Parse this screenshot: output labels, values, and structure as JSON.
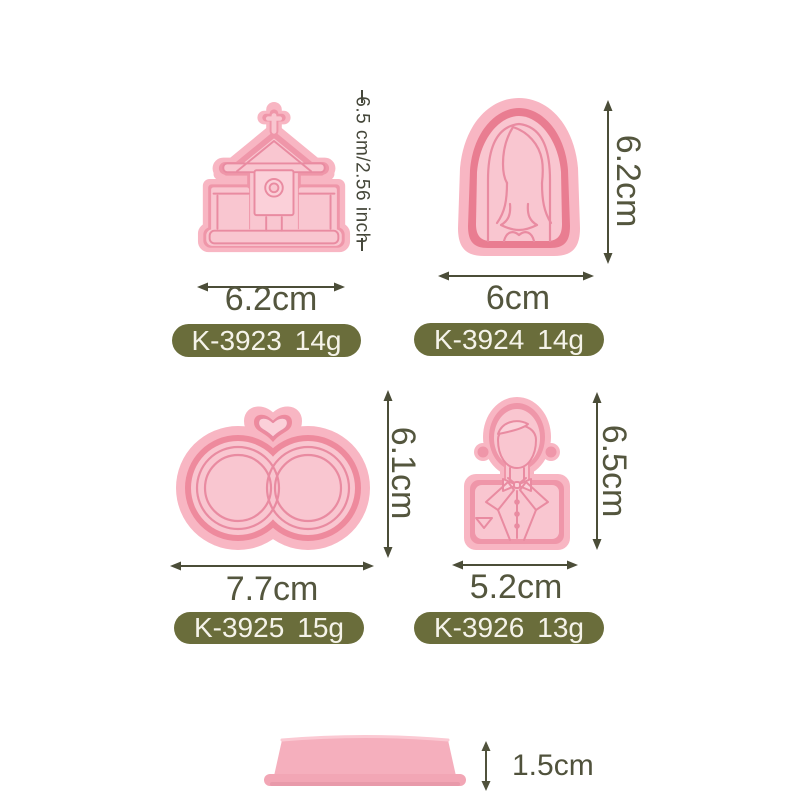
{
  "colors": {
    "cutter_pink": "#f8b6c3",
    "cutter_pink_dark": "#ef96a9",
    "cutter_plate": "#f9c6d0",
    "cutter_line": "#e98ba1",
    "badge_background": "#6a6d3b",
    "badge_text": "#f5f3e9",
    "dimension_text": "#54563e"
  },
  "products": [
    {
      "name": "church cookie cutter",
      "icon": "church-cutter-icon",
      "width": "6.2cm",
      "height": "6.5 cm/2.56 inch",
      "code": "K-3923",
      "weight": "14g"
    },
    {
      "name": "bride cookie cutter",
      "icon": "bride-cutter-icon",
      "width": "6cm",
      "height": "6.2cm",
      "code": "K-3924",
      "weight": "14g"
    },
    {
      "name": "wedding rings cookie cutter",
      "icon": "rings-cutter-icon",
      "width": "7.7cm",
      "height": "6.1cm",
      "code": "K-3925",
      "weight": "15g"
    },
    {
      "name": "groom cookie cutter",
      "icon": "groom-cutter-icon",
      "width": "5.2cm",
      "height": "6.5cm",
      "code": "K-3926",
      "weight": "13g"
    }
  ],
  "base_disc": {
    "name": "stamp base disc",
    "height": "1.5cm"
  }
}
